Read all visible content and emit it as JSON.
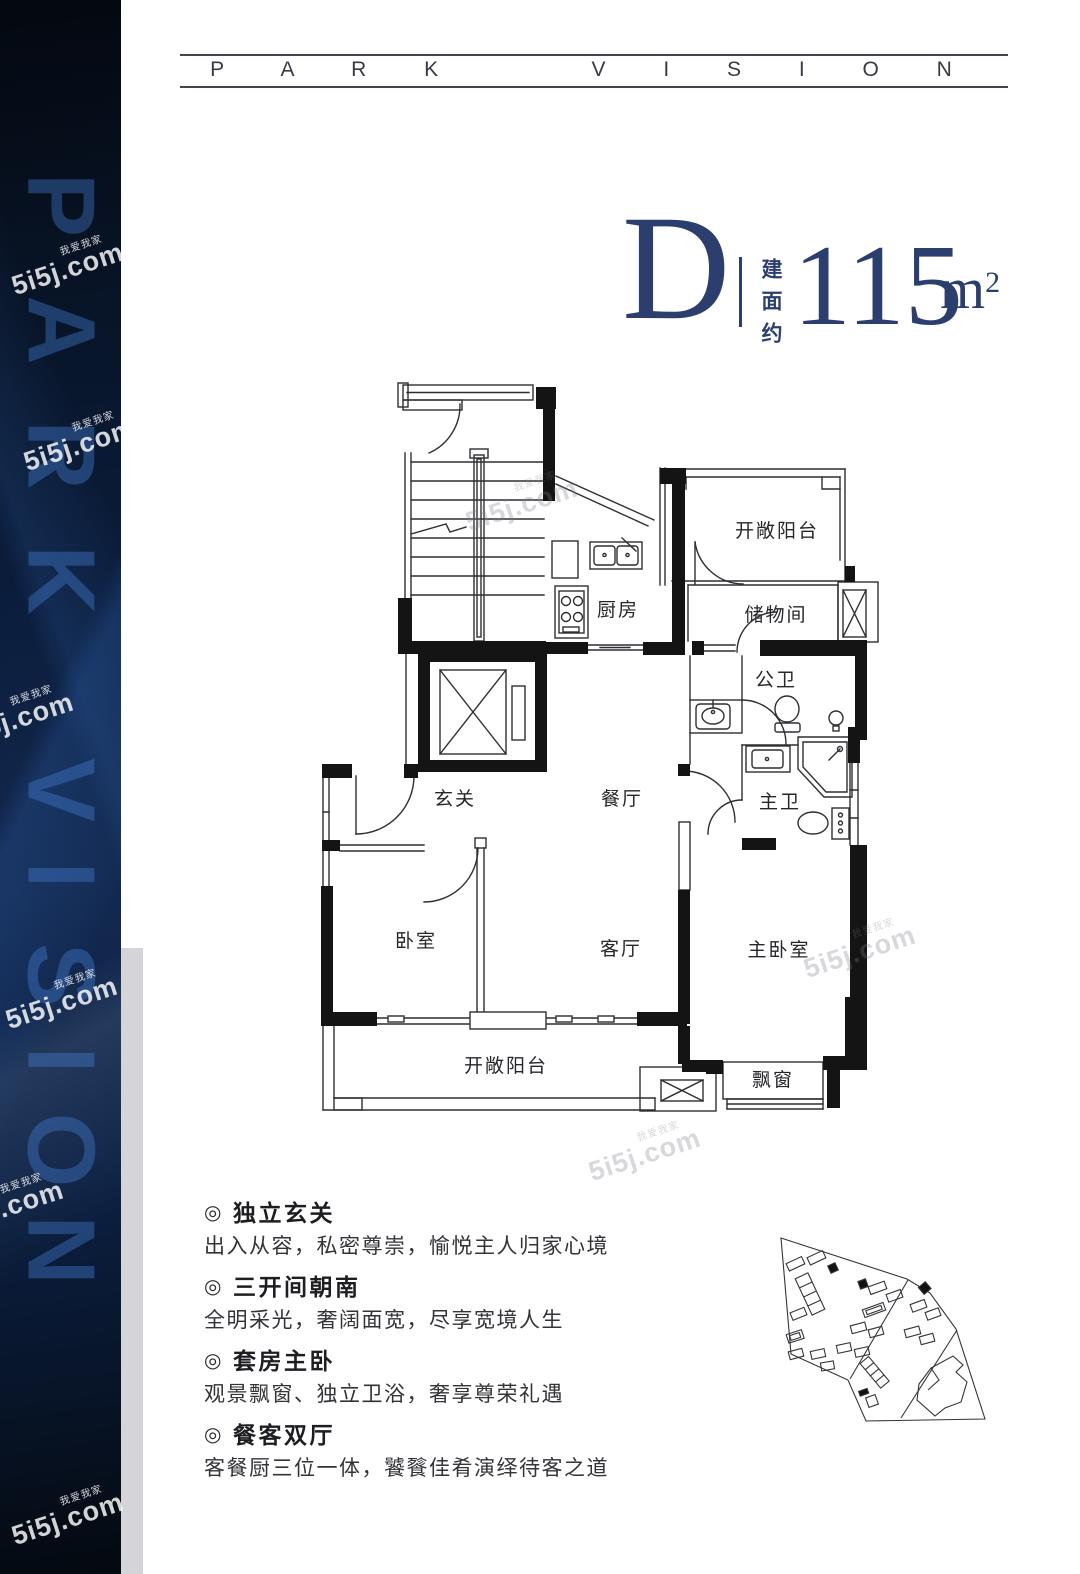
{
  "header": {
    "brand": "P A R K    V I S I O N"
  },
  "sideband": {
    "letters": [
      "P",
      "A",
      "R",
      "K",
      "V",
      "I",
      "S",
      "I",
      "O",
      "N"
    ]
  },
  "watermark": {
    "tag": "我爱我家",
    "main": "5i5j.com"
  },
  "title": {
    "unit_code": "D",
    "area_prefix": "建面约",
    "area_value": "115",
    "area_unit": "m",
    "area_unit_sup": "2"
  },
  "floorplan": {
    "rooms": {
      "balcony_top": "开敞阳台",
      "kitchen": "厨房",
      "storage": "储物间",
      "public_bath": "公卫",
      "foyer": "玄关",
      "dining": "餐厅",
      "master_bath": "主卫",
      "bedroom": "卧室",
      "living": "客厅",
      "master_bedroom": "主卧室",
      "balcony_bottom": "开敞阳台",
      "bay_window": "飘窗"
    }
  },
  "features": {
    "icon": "◎",
    "items": [
      {
        "title": "独立玄关",
        "desc": "出入从容，私密尊崇，愉悦主人归家心境"
      },
      {
        "title": "三开间朝南",
        "desc": "全明采光，奢阔面宽，尽享宽境人生"
      },
      {
        "title": "套房主卧",
        "desc": "观景飘窗、独立卫浴，奢享尊荣礼遇"
      },
      {
        "title": "餐客双厅",
        "desc": "客餐厨三位一体，饕餮佳肴演绎待客之道"
      }
    ]
  },
  "colors": {
    "accent_navy": "#2b3e6e",
    "band_dark": "#071223",
    "band_letter_blue": "#4884da",
    "plan_line": "#2f2f33",
    "wall_fill": "#141414"
  }
}
